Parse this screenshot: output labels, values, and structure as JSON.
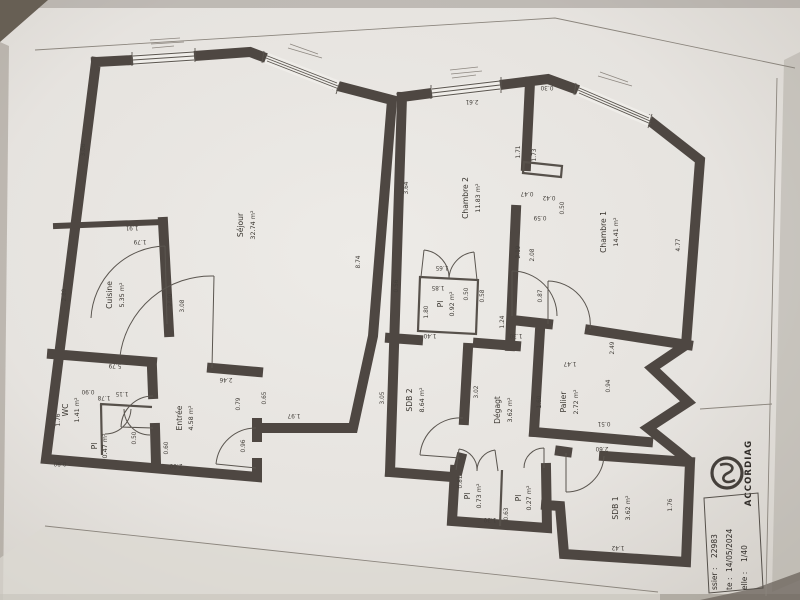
{
  "title_block": {
    "brand": "ACCORDIAG",
    "fields": [
      {
        "label": "ssier :",
        "value": "22983"
      },
      {
        "label": "te :",
        "value": "14/05/2024"
      },
      {
        "label": "elle :",
        "value": "1/40"
      }
    ]
  },
  "level1": {
    "rooms": [
      {
        "name": "Séjour",
        "area": "32.74 m²"
      },
      {
        "name": "Cuisine",
        "area": "5.35 m²"
      },
      {
        "name": "Entrée",
        "area": "4.58 m²"
      },
      {
        "name": "WC",
        "area": "1.41 m²"
      },
      {
        "name": "Pl",
        "area": "0.47 m²"
      }
    ],
    "dims": [
      "3.06",
      "2.89",
      "1.91",
      "1.79",
      "2.90",
      "3.08",
      "8.74",
      "5.79",
      "2.46",
      "1.76",
      "0.90",
      "0.80",
      "1.78",
      "1.15",
      "0.50",
      "0.60",
      "2.00",
      "0.96",
      "0.79",
      "0.65",
      "1.97"
    ]
  },
  "level2": {
    "rooms": [
      {
        "name": "Chambre 2",
        "area": "11.83 m²"
      },
      {
        "name": "Chambre 1",
        "area": "14.41 m²"
      },
      {
        "name": "Pl",
        "area": "0.92 m²"
      },
      {
        "name": "SDB 2",
        "area": "8.64 m²"
      },
      {
        "name": "Dégagt",
        "area": "3.62 m²"
      },
      {
        "name": "Palier",
        "area": "2.72 m²"
      },
      {
        "name": "Pl",
        "area": "0.73 m²"
      },
      {
        "name": "Pl",
        "area": "0.27 m²"
      },
      {
        "name": "SDB 1",
        "area": "3.62 m²"
      }
    ],
    "dims": [
      "2.61",
      "3.64",
      "1.71",
      "1.73",
      "0.47",
      "0.42",
      "0.50",
      "0.59",
      "2.19",
      "2.08",
      "4.77",
      "0.30",
      "1.65",
      "1.85",
      "1.80",
      "1.40",
      "0.56",
      "0.58",
      "1.24",
      "1.30",
      "0.87",
      "3.05",
      "3.02",
      "1.60",
      "1.47",
      "2.49",
      "0.94",
      "0.51",
      "0.81",
      "0.63",
      "2.60",
      "1.76",
      "1.42",
      "0.50",
      "1.30"
    ]
  }
}
